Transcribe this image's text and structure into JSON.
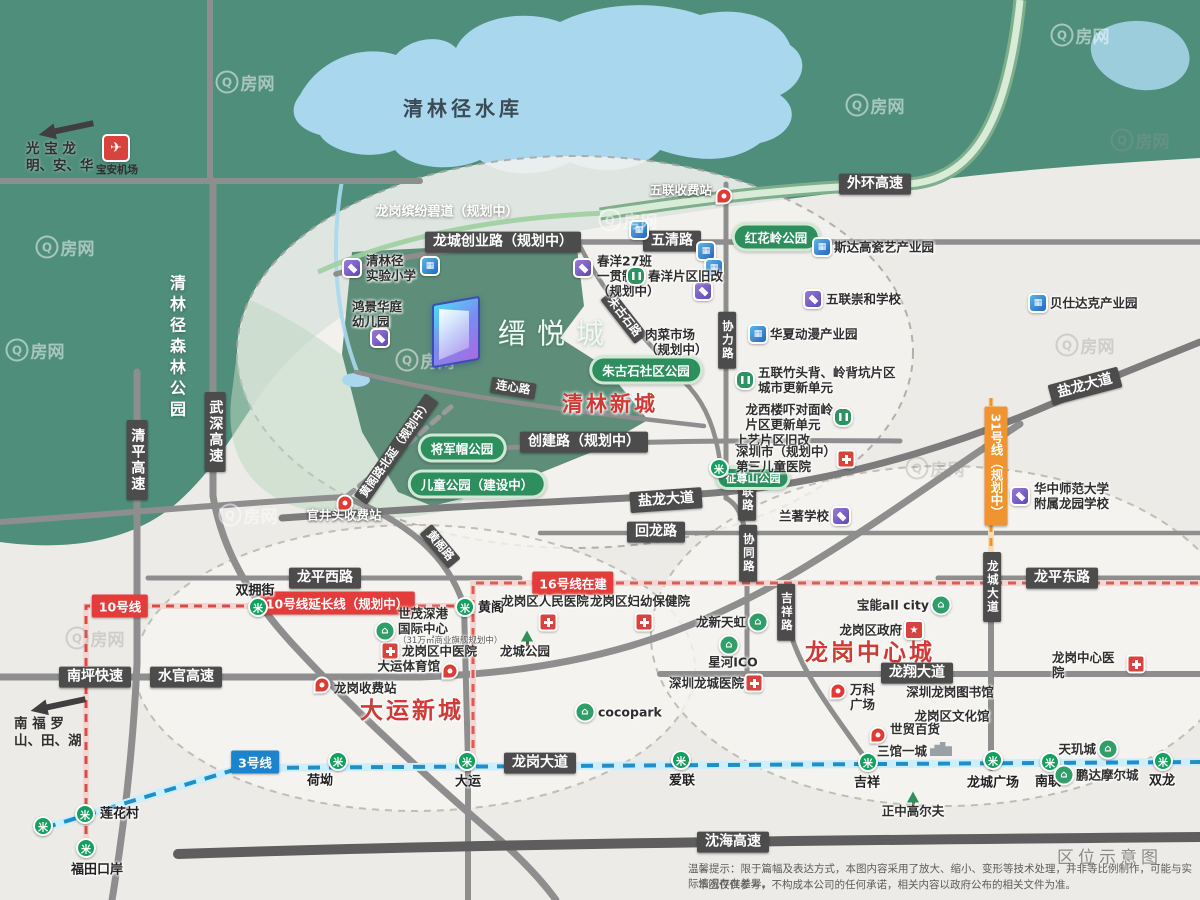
{
  "meta": {
    "caption": "区位示意图",
    "watermark": "Q房网",
    "logo_name": "缙悦城"
  },
  "footer": {
    "badge": "区位示意图",
    "line1": "温馨提示：限于篇幅及表达方式，本图内容采用了放大、缩小、变形等技术处理，并非等比例制作，可能与实际情况存在差异。",
    "line2": "本图仅供参考，不构成本公司的任何承诺，相关内容以政府公布的相关文件为准。"
  },
  "corners": {
    "nw": {
      "line1": "光  宝  龙",
      "line2": "明、安、华"
    },
    "sw": {
      "line1": "南  福  罗",
      "line2": "山、田、湖"
    },
    "airport": "宝安机场"
  },
  "colors": {
    "green_land": "#4f8e7b",
    "lake_blue": "#a9d8ee",
    "road_gray": "#8e8e8e",
    "red_accent": "#cf3a36",
    "metro3_blue": "#1b84cf",
    "metro10_red": "#e23d3a",
    "metro31_orange": "#ef9430",
    "pill_green": "#2e8f5e"
  },
  "map": {
    "big_labels": [
      {
        "t": "清林径水库",
        "x": 463,
        "y": 107,
        "cls": "lake"
      },
      {
        "t": "清林径森林公园",
        "x": 176,
        "y": 348,
        "cls": "forest"
      },
      {
        "t": "龙岗缤纷碧道（规划中）",
        "x": 447,
        "y": 210,
        "cls": "greenway"
      }
    ],
    "regions": [
      {
        "t": "清林新城",
        "x": 610,
        "y": 403,
        "fs": 21
      },
      {
        "t": "大运新城",
        "x": 412,
        "y": 708,
        "fs": 23
      },
      {
        "t": "龙岗中心城",
        "x": 870,
        "y": 650,
        "fs": 23
      }
    ],
    "road_labels": [
      {
        "t": "外环高速",
        "x": 875,
        "y": 184
      },
      {
        "t": "五清路",
        "x": 672,
        "y": 241
      },
      {
        "t": "龙城创业路（规划中）",
        "x": 503,
        "y": 242
      },
      {
        "t": "创建路（规划中）",
        "x": 584,
        "y": 442
      },
      {
        "t": "盐龙大道",
        "x": 666,
        "y": 500,
        "r": -4
      },
      {
        "t": "盐龙大道",
        "x": 1085,
        "y": 386,
        "r": -15
      },
      {
        "t": "回龙路",
        "x": 656,
        "y": 532
      },
      {
        "t": "龙平西路",
        "x": 325,
        "y": 578
      },
      {
        "t": "龙平东路",
        "x": 1062,
        "y": 578
      },
      {
        "t": "龙翔大道",
        "x": 917,
        "y": 673
      },
      {
        "t": "龙岗大道",
        "x": 540,
        "y": 763
      },
      {
        "t": "南坪快速",
        "x": 95,
        "y": 677
      },
      {
        "t": "水官高速",
        "x": 186,
        "y": 677
      },
      {
        "t": "沈海高速",
        "x": 733,
        "y": 842
      },
      {
        "t": "清平高速",
        "x": 137,
        "y": 460,
        "v": 1
      },
      {
        "t": "武深高速",
        "x": 215,
        "y": 432,
        "v": 1
      },
      {
        "t": "协力路",
        "x": 727,
        "y": 340,
        "v": 1,
        "s": 1
      },
      {
        "t": "协联路",
        "x": 747,
        "y": 492,
        "v": 1,
        "s": 1
      },
      {
        "t": "协同路",
        "x": 748,
        "y": 553,
        "v": 1,
        "s": 1
      },
      {
        "t": "吉祥路",
        "x": 786,
        "y": 612,
        "v": 1,
        "s": 1
      },
      {
        "t": "龙城大道",
        "x": 992,
        "y": 587,
        "v": 1,
        "s": 1
      },
      {
        "t": "连心路",
        "x": 513,
        "y": 388,
        "r": 9,
        "s": 1
      },
      {
        "t": "黄阁路",
        "x": 440,
        "y": 546,
        "r": 50,
        "s": 1
      },
      {
        "t": "朱古石路",
        "x": 624,
        "y": 317,
        "r": 52,
        "s": 1
      },
      {
        "t": "黄阁路北延（规划中）",
        "x": 396,
        "y": 449,
        "r": -55,
        "s": 1
      }
    ],
    "metro_labels": [
      {
        "t": "3号线",
        "x": 255,
        "y": 762,
        "c": "#1b84cf"
      },
      {
        "t": "10号线",
        "x": 120,
        "y": 606,
        "c": "#e23d3a"
      },
      {
        "t": "10号线延长线（规划中）",
        "x": 337,
        "y": 603,
        "c": "#e23d3a"
      },
      {
        "t": "16号线在建",
        "x": 573,
        "y": 583,
        "c": "#e23d3a"
      },
      {
        "t": "31号线（规划中）",
        "x": 996,
        "y": 466,
        "c": "#ef9430",
        "v": 1
      }
    ],
    "pills": [
      {
        "t": "红花岭公园",
        "x": 776,
        "y": 237
      },
      {
        "t": "朱古石社区公园",
        "x": 646,
        "y": 370
      },
      {
        "t": "将军帽公园",
        "x": 462,
        "y": 448
      },
      {
        "t": "儿童公园（建设中）",
        "x": 477,
        "y": 484
      },
      {
        "t": "征尊山公园",
        "x": 753,
        "y": 478,
        "s": 1
      }
    ],
    "stations": [
      {
        "x": 258,
        "y": 607,
        "t": "双拥街",
        "lx": 255,
        "ly": 589,
        "la": "c"
      },
      {
        "x": 465,
        "y": 607,
        "t": "黄阁",
        "lx": 478,
        "ly": 606,
        "la": "l"
      },
      {
        "x": 338,
        "y": 761,
        "t": "荷坳",
        "lx": 320,
        "ly": 779,
        "la": "c"
      },
      {
        "x": 467,
        "y": 761,
        "t": "大运",
        "lx": 468,
        "ly": 780,
        "la": "c"
      },
      {
        "x": 681,
        "y": 760,
        "t": "爱联",
        "lx": 682,
        "ly": 779,
        "la": "c"
      },
      {
        "x": 868,
        "y": 762,
        "t": "吉祥",
        "lx": 867,
        "ly": 781,
        "la": "c"
      },
      {
        "x": 993,
        "y": 760,
        "t": "龙城广场",
        "lx": 993,
        "ly": 781,
        "la": "c"
      },
      {
        "x": 1050,
        "y": 762,
        "t": "南联",
        "lx": 1048,
        "ly": 780,
        "la": "c"
      },
      {
        "x": 1163,
        "y": 761,
        "t": "双龙",
        "lx": 1162,
        "ly": 779,
        "la": "c"
      },
      {
        "x": 85,
        "y": 814,
        "t": "莲花村",
        "lx": 100,
        "ly": 812,
        "la": "l"
      },
      {
        "x": 86,
        "y": 848,
        "t": "福田口岸",
        "lx": 97,
        "ly": 868,
        "la": "c"
      },
      {
        "x": 43,
        "y": 826
      },
      {
        "x": 719,
        "y": 468
      }
    ],
    "pois": [
      {
        "ic": "ind",
        "x": 822,
        "y": 247,
        "t": "斯达高瓷艺产业园",
        "lx": 834,
        "ly": 247,
        "la": "l"
      },
      {
        "ic": "ind",
        "x": 1038,
        "y": 303,
        "t": "贝仕达克产业园",
        "lx": 1050,
        "ly": 303,
        "la": "l"
      },
      {
        "ic": "ind",
        "x": 758,
        "y": 334,
        "t": "华夏动漫产业园",
        "lx": 770,
        "ly": 334,
        "la": "l"
      },
      {
        "ic": "ind",
        "x": 639,
        "y": 230
      },
      {
        "ic": "ind",
        "x": 706,
        "y": 251
      },
      {
        "ic": "ind",
        "x": 714,
        "y": 268
      },
      {
        "ic": "ind",
        "x": 430,
        "y": 266
      },
      {
        "ic": "sch",
        "x": 352,
        "y": 268,
        "t": "清林径\n实验小学",
        "lx": 366,
        "ly": 268,
        "la": "l"
      },
      {
        "ic": "sch",
        "x": 380,
        "y": 338,
        "t": "鸿景华庭\n幼儿园",
        "lx": 352,
        "ly": 314,
        "la": "l"
      },
      {
        "ic": "sch",
        "x": 583,
        "y": 268,
        "t": "春洋27班\n一贯制\n（规划中）",
        "lx": 597,
        "ly": 276,
        "la": "l"
      },
      {
        "ic": "sch",
        "x": 813,
        "y": 299,
        "t": "五联崇和学校",
        "lx": 826,
        "ly": 299,
        "la": "l"
      },
      {
        "ic": "sch",
        "x": 841,
        "y": 516,
        "t": "兰著学校",
        "lx": 829,
        "ly": 516,
        "la": "r"
      },
      {
        "ic": "sch",
        "x": 1020,
        "y": 496,
        "t": "华中师范大学\n附属龙园学校",
        "lx": 1034,
        "ly": 496,
        "la": "l"
      },
      {
        "ic": "sch",
        "x": 703,
        "y": 291
      },
      {
        "ic": "ren",
        "x": 636,
        "y": 276,
        "t": "春洋片区旧改",
        "lx": 648,
        "ly": 276,
        "la": "l"
      },
      {
        "ic": "ren",
        "x": 745,
        "y": 380,
        "t": "五联竹头背、岭背坑片区\n城市更新单元",
        "lx": 758,
        "ly": 380,
        "la": "l"
      },
      {
        "ic": "ren",
        "x": 843,
        "y": 417,
        "t": "龙西楼吓对面岭\n片区更新单元",
        "lx": 833,
        "ly": 417,
        "la": "r"
      },
      {
        "t": "上艺片区旧改",
        "lx": 735,
        "ly": 440,
        "la": "l"
      },
      {
        "t": "肉菜市场\n（规划中）",
        "lx": 645,
        "ly": 342,
        "la": "l"
      },
      {
        "t": "深圳龙岗图书馆",
        "lx": 950,
        "ly": 692,
        "la": "c"
      },
      {
        "t": "龙岗区文化馆",
        "lx": 952,
        "ly": 716,
        "la": "c"
      },
      {
        "ic": "hos",
        "x": 548,
        "y": 622,
        "t": "龙岗区人民医院",
        "lx": 545,
        "ly": 601,
        "la": "c"
      },
      {
        "ic": "hos",
        "x": 644,
        "y": 622,
        "t": "龙岗区妇幼保健院",
        "lx": 640,
        "ly": 601,
        "la": "c"
      },
      {
        "ic": "hos",
        "x": 846,
        "y": 459,
        "t": "深圳市（规划中）\n第三儿童医院",
        "lx": 836,
        "ly": 459,
        "la": "r"
      },
      {
        "ic": "hos",
        "x": 754,
        "y": 683,
        "t": "深圳龙城医院",
        "lx": 744,
        "ly": 683,
        "la": "r"
      },
      {
        "ic": "hos",
        "x": 1136,
        "y": 664,
        "t": "龙岗中心医院",
        "lx": 1126,
        "ly": 665,
        "la": "r"
      },
      {
        "ic": "hos",
        "x": 390,
        "y": 651,
        "t": "龙岗区中医院",
        "lx": 402,
        "ly": 651,
        "la": "l"
      },
      {
        "ic": "pin",
        "x": 724,
        "y": 196,
        "t": "五联收费站",
        "lx": 712,
        "ly": 190,
        "la": "r",
        "w": 1
      },
      {
        "ic": "pin",
        "x": 345,
        "y": 503,
        "t": "官井头收费站",
        "lx": 344,
        "ly": 515,
        "la": "c",
        "w": 1
      },
      {
        "ic": "pin",
        "x": 322,
        "y": 685,
        "t": "龙岗收费站",
        "lx": 334,
        "ly": 688,
        "la": "l"
      },
      {
        "ic": "pin",
        "x": 450,
        "y": 671,
        "t": "大运体育馆",
        "lx": 440,
        "ly": 666,
        "la": "r"
      },
      {
        "ic": "pin",
        "x": 838,
        "y": 691,
        "t": "万科\n广场",
        "lx": 850,
        "ly": 697,
        "la": "l"
      },
      {
        "ic": "pin",
        "x": 878,
        "y": 735,
        "t": "世贸百货",
        "lx": 890,
        "ly": 729,
        "la": "l"
      },
      {
        "ic": "shop",
        "x": 758,
        "y": 622,
        "t": "龙新天虹",
        "lx": 746,
        "ly": 622,
        "la": "r"
      },
      {
        "ic": "shop",
        "x": 729,
        "y": 645,
        "t": "星河ICO",
        "lx": 733,
        "ly": 662,
        "la": "c"
      },
      {
        "ic": "shop",
        "x": 941,
        "y": 605,
        "t": "宝能all city",
        "lx": 929,
        "ly": 605,
        "la": "r"
      },
      {
        "ic": "shop",
        "x": 585,
        "y": 712,
        "t": "cocopark",
        "lx": 598,
        "ly": 712,
        "la": "l"
      },
      {
        "ic": "shop",
        "x": 1108,
        "y": 749,
        "t": "天玑城",
        "lx": 1096,
        "ly": 749,
        "la": "r"
      },
      {
        "ic": "shop",
        "x": 1064,
        "y": 775,
        "t": "鹏达摩尔城",
        "lx": 1076,
        "ly": 775,
        "la": "l"
      },
      {
        "ic": "shop",
        "x": 385,
        "y": 631,
        "t": "世茂深港\n国际中心",
        "lx": 398,
        "ly": 626,
        "la": "l",
        "sub": "（31万㎡商业旗舰规划中）"
      },
      {
        "ic": "gov",
        "x": 914,
        "y": 630,
        "t": "龙岗区政府",
        "lx": 902,
        "ly": 630,
        "la": "r"
      },
      {
        "ic": "tree",
        "x": 527,
        "y": 636,
        "t": "龙城公园",
        "lx": 525,
        "ly": 651,
        "la": "c"
      },
      {
        "ic": "tree",
        "x": 913,
        "y": 797,
        "t": "正中高尔夫",
        "lx": 913,
        "ly": 811,
        "la": "c"
      },
      {
        "ic": "bld",
        "x": 941,
        "y": 749,
        "t": "三馆一城",
        "lx": 927,
        "ly": 751,
        "la": "r"
      }
    ],
    "watermarks": [
      {
        "x": 245,
        "y": 82
      },
      {
        "x": 875,
        "y": 105
      },
      {
        "x": 1080,
        "y": 35
      },
      {
        "x": 1140,
        "y": 140,
        "dk": 1
      },
      {
        "x": 65,
        "y": 247
      },
      {
        "x": 35,
        "y": 350
      },
      {
        "x": 248,
        "y": 515
      },
      {
        "x": 425,
        "y": 360
      },
      {
        "x": 628,
        "y": 220
      },
      {
        "x": 1085,
        "y": 345,
        "dk": 1
      },
      {
        "x": 95,
        "y": 638,
        "dk": 1
      },
      {
        "x": 935,
        "y": 468,
        "dk": 1
      }
    ]
  }
}
